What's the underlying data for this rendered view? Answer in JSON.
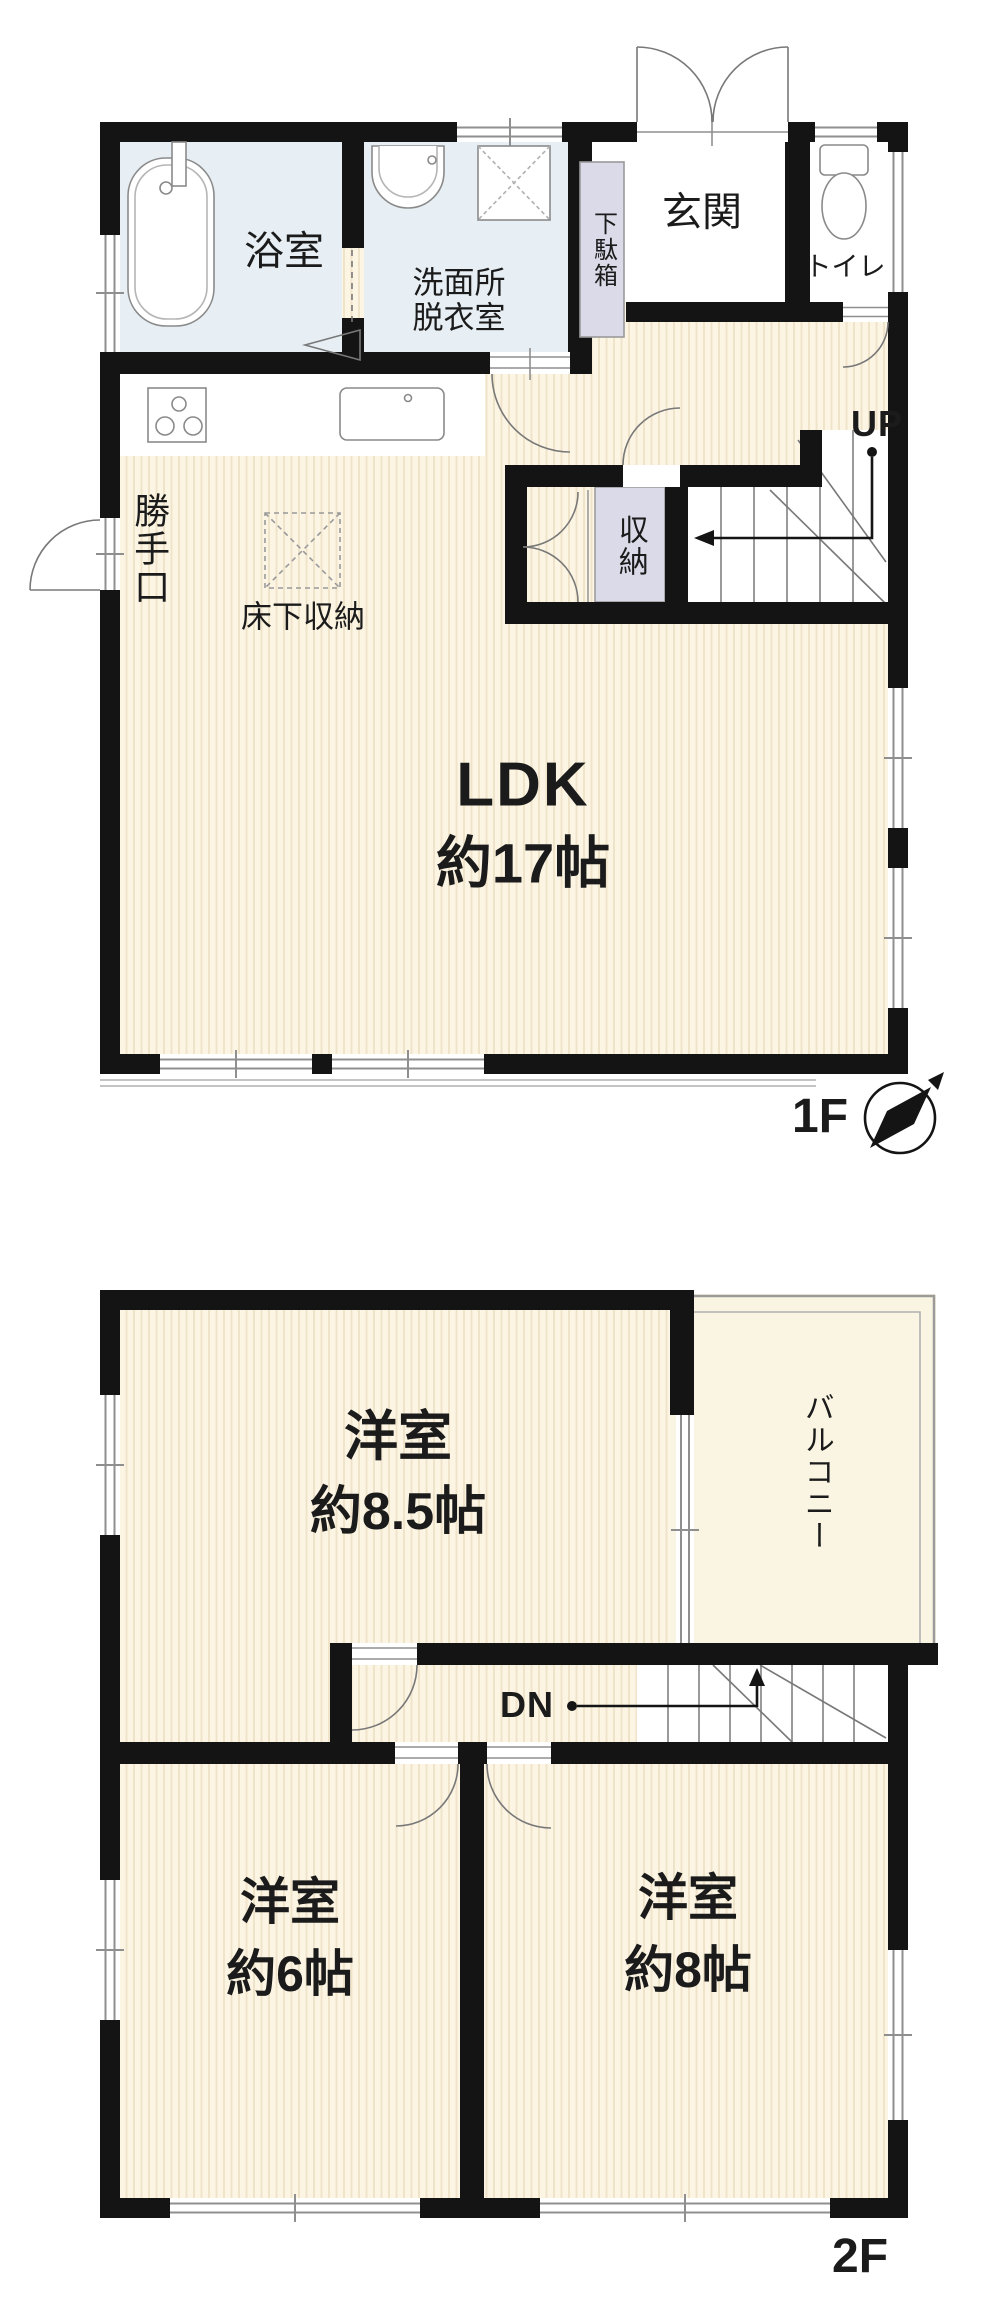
{
  "title": "2-story house floor plan",
  "colors": {
    "wall": "#141414",
    "floor_stripe_base": "#fcf5e4",
    "floor_stripe_line": "#efe4ca",
    "wet_room": "#e7eff4",
    "cabinet": "#dbdae8",
    "balcony": "#faf5e2",
    "outline_gray": "#8f8f8f",
    "text": "#1b1b1b"
  },
  "floor1": {
    "floor_label": "1F",
    "bath_label": "浴室",
    "washroom_label_line1": "洗面所",
    "washroom_label_line2": "脱衣室",
    "entrance_label": "玄関",
    "toilet_label": "トイレ",
    "shoe_cabinet_label": "下駄箱",
    "back_door_label": "勝手口",
    "underfloor_storage_label": "床下収納",
    "storage_label": "収納",
    "stairs_label": "UP",
    "ldk_label": "LDK",
    "ldk_size_label": "約17帖"
  },
  "floor2": {
    "floor_label": "2F",
    "bedroom_a_label": "洋室",
    "bedroom_a_size_label": "約8.5帖",
    "balcony_label": "バルコニー",
    "stairs_label": "DN",
    "bedroom_b_label": "洋室",
    "bedroom_b_size_label": "約6帖",
    "bedroom_c_label": "洋室",
    "bedroom_c_size_label": "約8帖"
  },
  "icons": {
    "compass": "compass-needle-pointing-northeast",
    "fixtures": [
      "bathtub",
      "washbasin",
      "washing-machine-pan",
      "toilet",
      "gas-stove",
      "kitchen-sink",
      "underfloor-storage-hatch"
    ]
  }
}
